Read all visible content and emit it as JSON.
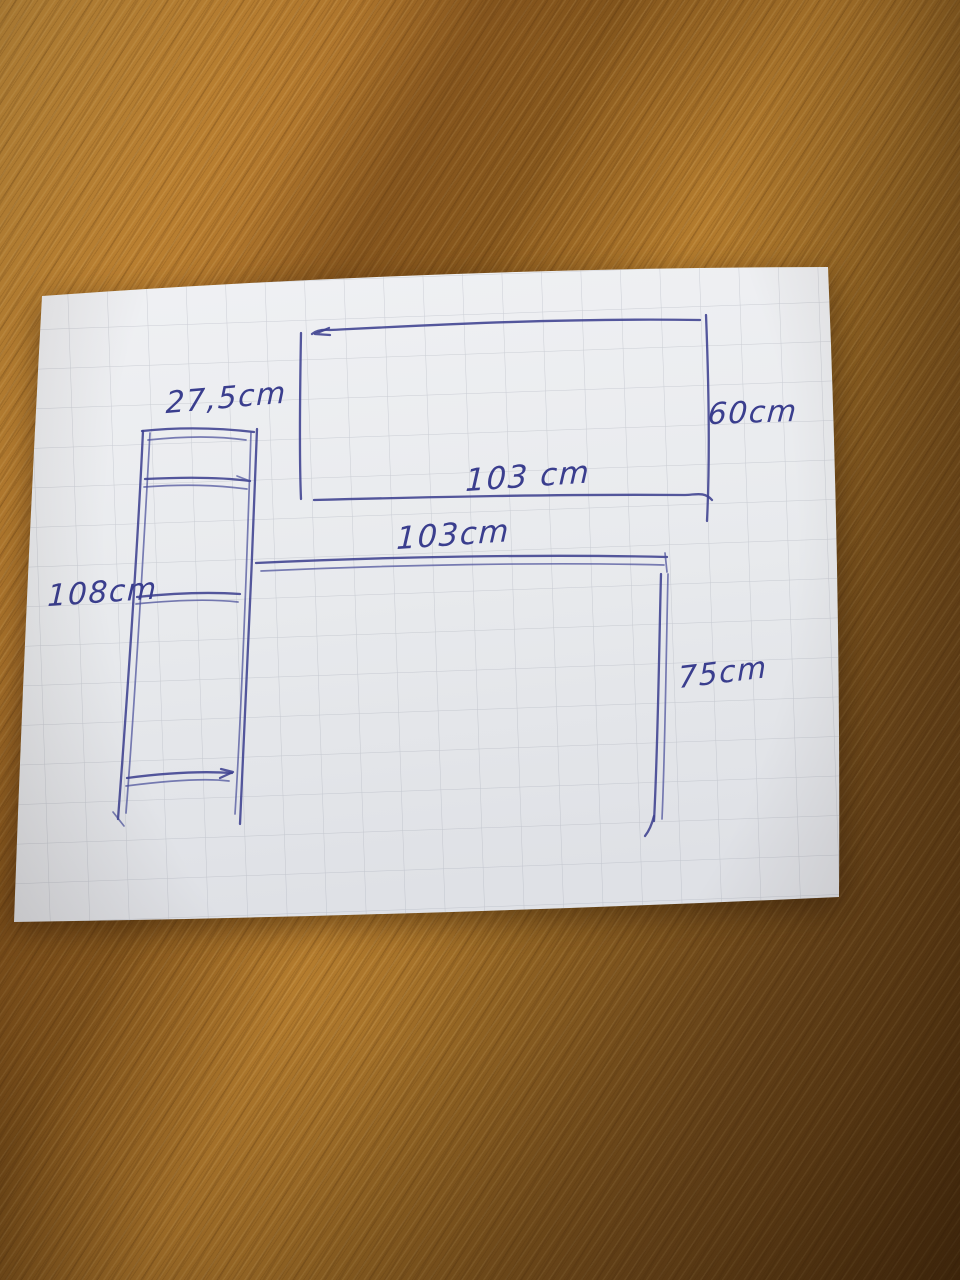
{
  "sketch": {
    "ink_color": "#3d4190",
    "paper_color": "#e9ebee",
    "grid_color": "#9aa0ab",
    "wood_colors": {
      "light": "#c8913d",
      "mid": "#a06826",
      "dark": "#6e4718"
    },
    "shelf": {
      "width": "27,5cm",
      "height": "108cm"
    },
    "panel": {
      "width": "103 cm",
      "height": "60cm"
    },
    "desk": {
      "width": "103cm",
      "height": "75cm"
    }
  }
}
